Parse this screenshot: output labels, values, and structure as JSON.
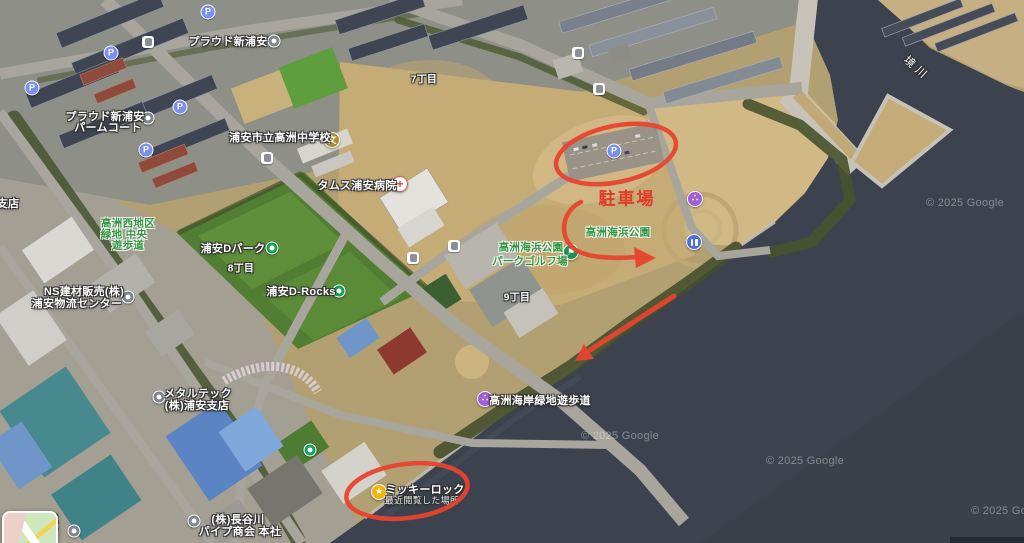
{
  "map": {
    "watermark": "© 2025 Google",
    "annotations": {
      "parking_text": "駐車場",
      "color": "#e8432e",
      "shapes": [
        "ellipse-around-parking-lot",
        "curved-arrow",
        "straight-arrow-along-coast",
        "ellipse-around-mickey-rock"
      ]
    },
    "icons": {
      "parking_glyph": "P",
      "school_glyph": "文",
      "hospital_glyph": "+",
      "golf_glyph": "⚑",
      "attraction_glyph": "∴",
      "star_glyph": "★"
    },
    "districts": {
      "d7": "7丁目",
      "d8": "8丁目",
      "d9": "9丁目"
    },
    "water": {
      "sakai_river": "境川"
    },
    "parks": {
      "west_greenway_l1": "高洲西地区",
      "west_greenway_l2": "緑地 中央",
      "west_greenway_l3": "遊歩道",
      "kaihin_park": "高洲海浜公園",
      "park_golf_l1": "高洲海浜公園",
      "park_golf_l2": "パークゴルフ場"
    },
    "pois": {
      "proud_shin_urayasu": "プラウド新浦安",
      "proud_palm_court_l1": "プラウド新浦安",
      "proud_palm_court_l2": "パームコート",
      "takasu_junior_high": "浦安市立高洲中学校",
      "tams_hospital": "タムス浦安病院",
      "urayasu_d_park": "浦安Dパーク",
      "urayasu_d_rocks": "浦安D-Rocks",
      "ns_kenzai_l1": "NS建材販売(株)",
      "ns_kenzai_l2": "浦安物流センター",
      "metaltech_l1": "メタルテック",
      "metaltech_l2": "(株)浦安支店",
      "hasegawa_l1": "(株)長谷川",
      "hasegawa_l2": "パイプ商会 本社",
      "coast_walkway": "高洲海岸緑地遊歩道",
      "mickey_rock": "ミッキーロック",
      "mickey_rock_sub": "最近閲覧した場所",
      "edge_partial_shiten": "支店",
      "edge_partial_shikiten": "式店"
    }
  }
}
